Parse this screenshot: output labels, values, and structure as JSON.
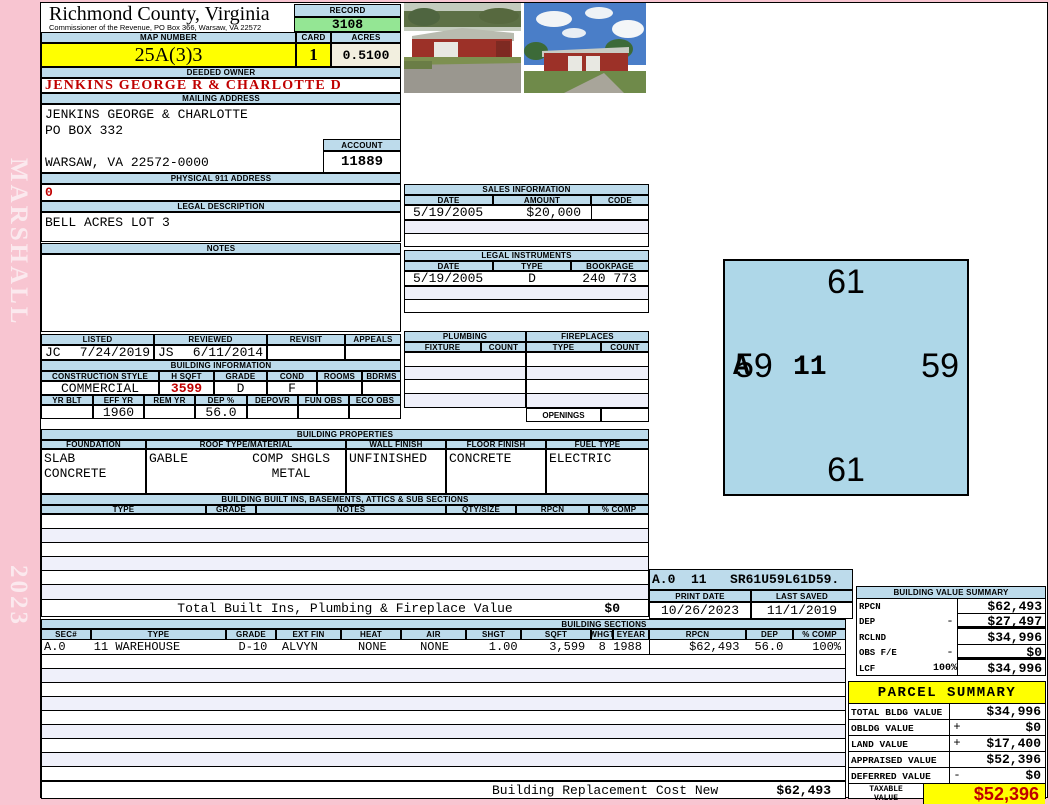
{
  "app": {
    "vendor": "MARSHALL",
    "year": "2023"
  },
  "header": {
    "county": "Richmond County, Virginia",
    "commissioner": "Commissioner of the Revenue, PO Box 366, Warsaw, VA 22572",
    "record_label": "RECORD",
    "record": "3108",
    "map_number_label": "MAP NUMBER",
    "map_number": "25A(3)3",
    "card_label": "CARD",
    "card": "1",
    "acres_label": "ACRES",
    "acres": "0.5100"
  },
  "owner": {
    "deeded_owner_label": "DEEDED OWNER",
    "deeded_owner": "JENKINS GEORGE R & CHARLOTTE D",
    "mailing_address_label": "MAILING ADDRESS",
    "mailing_line1": "JENKINS GEORGE & CHARLOTTE",
    "mailing_line2": "PO BOX 332",
    "mailing_line3": "WARSAW, VA 22572-0000",
    "account_label": "ACCOUNT",
    "account": "11889",
    "physical_address_label": "PHYSICAL 911 ADDRESS",
    "physical_address": "0",
    "legal_description_label": "LEGAL DESCRIPTION",
    "legal_description": "BELL ACRES LOT 3",
    "notes_label": "NOTES",
    "notes": ""
  },
  "review": {
    "listed_label": "LISTED",
    "reviewed_label": "REVIEWED",
    "revisit_label": "REVISIT",
    "appeals_label": "APPEALS",
    "listed_by": "JC",
    "listed_date": "7/24/2019",
    "reviewed_by": "JS",
    "reviewed_date": "6/11/2014",
    "revisit": "",
    "appeals": ""
  },
  "building_information": {
    "title": "BUILDING INFORMATION",
    "h1": [
      "CONSTRUCTION STYLE",
      "H SQFT",
      "GRADE",
      "COND",
      "ROOMS",
      "BDRMS"
    ],
    "v1": [
      "COMMERCIAL",
      "3599",
      "D",
      "F",
      "",
      ""
    ],
    "h2": [
      "YR BLT",
      "EFF YR",
      "REM YR",
      "DEP %",
      "DEPOVR",
      "FUN OBS",
      "ECO OBS"
    ],
    "v2": [
      "",
      "1960",
      "",
      "56.0",
      "",
      "",
      ""
    ]
  },
  "building_properties": {
    "title": "BUILDING PROPERTIES",
    "headers": [
      "FOUNDATION",
      "ROOF TYPE/MATERIAL",
      "WALL FINISH",
      "FLOOR FINISH",
      "FUEL TYPE"
    ],
    "foundation_line1": "SLAB",
    "foundation_line2": "CONCRETE",
    "roof_type": "GABLE",
    "roof_material_line1": "COMP SHGLS",
    "roof_material_line2": "METAL",
    "wall_finish": "UNFINISHED",
    "floor_finish": "CONCRETE",
    "fuel_type": "ELECTRIC"
  },
  "built_ins": {
    "title": "BUILDING BUILT INS, BASEMENTS, ATTICS & SUB SECTIONS",
    "headers": [
      "TYPE",
      "GRADE",
      "NOTES",
      "QTY/SIZE",
      "RPCN",
      "% COMP"
    ],
    "total_label": "Total Built Ins, Plumbing & Fireplace Value",
    "total_value": "$0"
  },
  "sales": {
    "title": "SALES INFORMATION",
    "headers": [
      "DATE",
      "AMOUNT",
      "CODE"
    ],
    "row1": {
      "date": "5/19/2005",
      "amount": "$20,000",
      "code": ""
    }
  },
  "legal_instruments": {
    "title": "LEGAL INSTRUMENTS",
    "headers": [
      "DATE",
      "TYPE",
      "BOOKPAGE"
    ],
    "row1": {
      "date": "5/19/2005",
      "type": "D",
      "book_page": "240 773"
    }
  },
  "plumbing": {
    "title": "PLUMBING",
    "fixture_label": "FIXTURE",
    "count_label": "COUNT"
  },
  "fireplaces": {
    "title": "FIREPLACES",
    "type_label": "TYPE",
    "count_label": "COUNT",
    "openings_label": "OPENINGS",
    "openings": ""
  },
  "sketch": {
    "dim_top": "61",
    "dim_right": "59",
    "dim_bottom": "61",
    "dim_left": "59",
    "section_label": "A",
    "section_type": "11",
    "vector": "A.0  11   SR61U59L61D59."
  },
  "meta": {
    "print_date_label": "PRINT DATE",
    "print_date": "10/26/2023",
    "last_saved_label": "LAST SAVED",
    "last_saved": "11/1/2019"
  },
  "building_sections": {
    "title": "BUILDING SECTIONS",
    "headers": [
      "SEC#",
      "TYPE",
      "GRADE",
      "EXT FIN",
      "HEAT",
      "AIR",
      "SHGT",
      "SQFT",
      "WHGT",
      "EYEAR",
      "RPCN",
      "DEP",
      "% COMP"
    ],
    "row1": [
      "A.0",
      "11 WAREHOUSE",
      "D-10",
      "ALVYN",
      "NONE",
      "NONE",
      "1.00",
      "3,599",
      "8",
      "1988",
      "$62,493",
      "56.0",
      "100%"
    ],
    "replacement_cost_label": "Building Replacement Cost New",
    "replacement_cost": "$62,493"
  },
  "building_value_summary": {
    "title": "BUILDING VALUE SUMMARY",
    "rpcn_label": "RPCN",
    "rpcn": "$62,493",
    "dep_label": "DEP",
    "dep_op": "-",
    "dep": "$27,497",
    "rclnd_label": "RCLND",
    "rclnd": "$34,996",
    "obs_label": "OBS F/E",
    "obs_op": "-",
    "obs": "$0",
    "lcf_label": "LCF",
    "lcf_pct": "100%",
    "lcf": "$34,996"
  },
  "parcel_summary": {
    "title": "PARCEL SUMMARY",
    "total_bldg_label": "TOTAL BLDG VALUE",
    "total_bldg": "$34,996",
    "obldg_label": "OBLDG VALUE",
    "obldg_op": "+",
    "obldg": "$0",
    "land_label": "LAND VALUE",
    "land_op": "+",
    "land": "$17,400",
    "appraised_label": "APPRAISED VALUE",
    "appraised": "$52,396",
    "deferred_label": "DEFERRED VALUE",
    "deferred_op": "-",
    "deferred": "$0",
    "taxable_label": "TAXABLE VALUE",
    "taxable": "$52,396"
  },
  "colors": {
    "pink": "#F8C5D1",
    "header_blue": "#BDDBEB",
    "record_green": "#94E694",
    "highlight_yellow": "#FFFF00",
    "value_red": "#C00000",
    "acres_cream": "#F2EFDF",
    "sketch_blue": "#AED7E8"
  }
}
